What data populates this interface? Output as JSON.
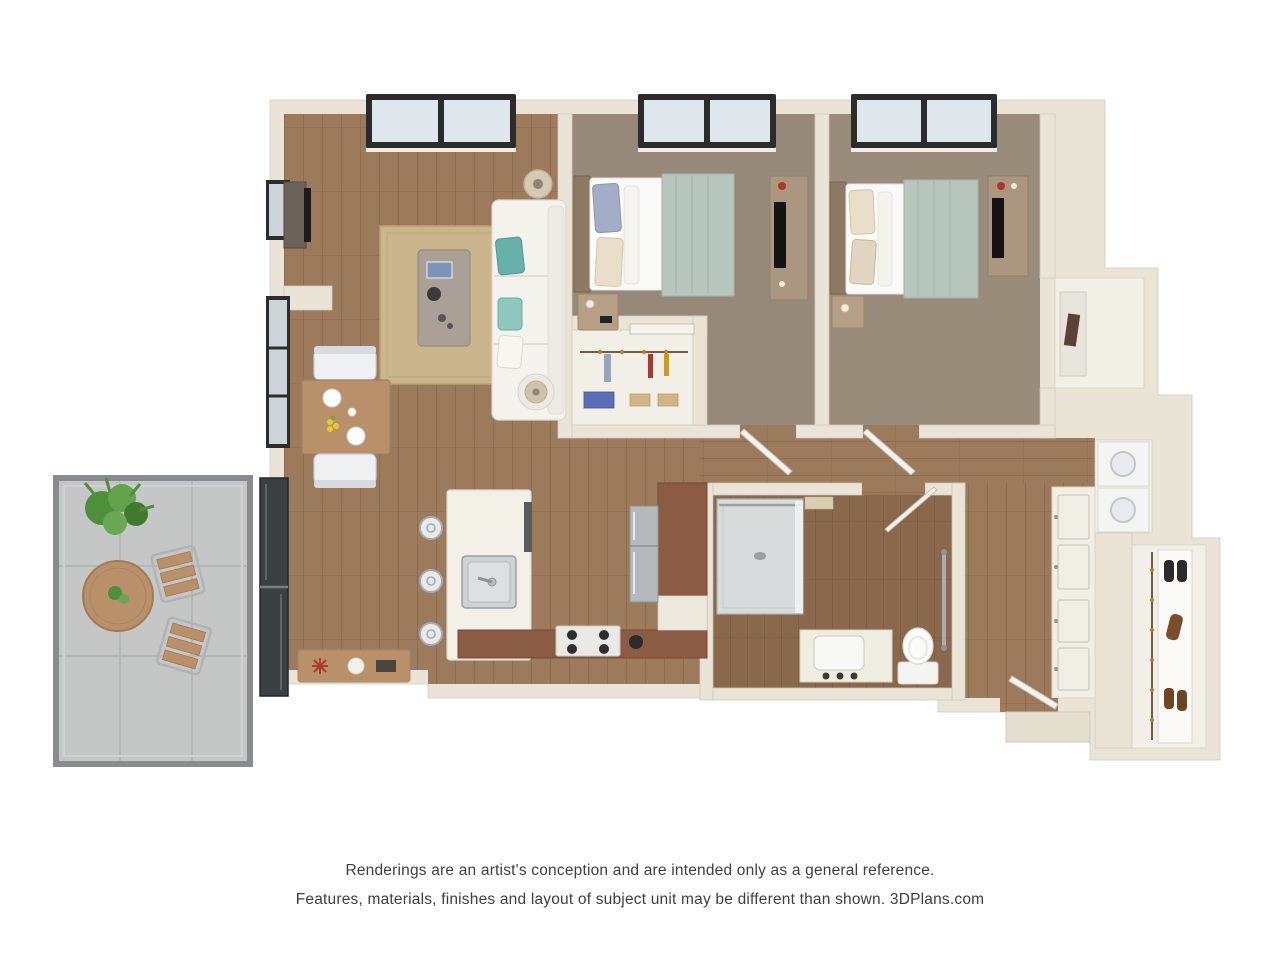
{
  "page": {
    "background": "#ffffff",
    "kind": "3D floor plan rendering"
  },
  "disclaimer": {
    "line1": "Renderings are an artist's conception and are intended only as a general reference.",
    "line2": "Features, materials, finishes and layout of subject unit may be different than shown. 3DPlans.com"
  },
  "branding": {
    "site": "3DPlans.com"
  },
  "rooms_depicted": [
    "balcony",
    "living room",
    "dining area",
    "kitchen",
    "hallway",
    "bedroom 1",
    "bedroom 2",
    "bathroom",
    "closets",
    "laundry niche",
    "entry foyer"
  ],
  "palette": {
    "wall": "#e9e4d6",
    "wallEdge": "#d2cbbc",
    "wood": "#9b7b5b",
    "woodLine": "#85613f",
    "woodDark": "#8a684b",
    "woodDarkLine": "#74533a",
    "carpet1": "#97897a",
    "carpet2": "#9a8c7b",
    "rug": "#cab68c",
    "rugEdge": "#b7a071",
    "sofa": "#f4f2ec",
    "teal": "#68b1a8",
    "sage": "#b7c6bc",
    "brownCab": "#8a5c43",
    "island": "#f3f0e8",
    "steel": "#b6b9bb",
    "concrete": "#c5c7c6",
    "railing": "#888c8e",
    "plantGreen": "#4e8f3c",
    "tableWood": "#b8906a",
    "furnWood": "#ab9780",
    "headboard": "#8d7a65",
    "closetInt": "#f2efe6",
    "glassDark": "#3b4044",
    "winFrame": "#2b2c2e",
    "glass": "#dde7ec",
    "white": "#fafaf8",
    "doorLeaf": "#f5f3ec",
    "text": "#3f3f3f"
  }
}
